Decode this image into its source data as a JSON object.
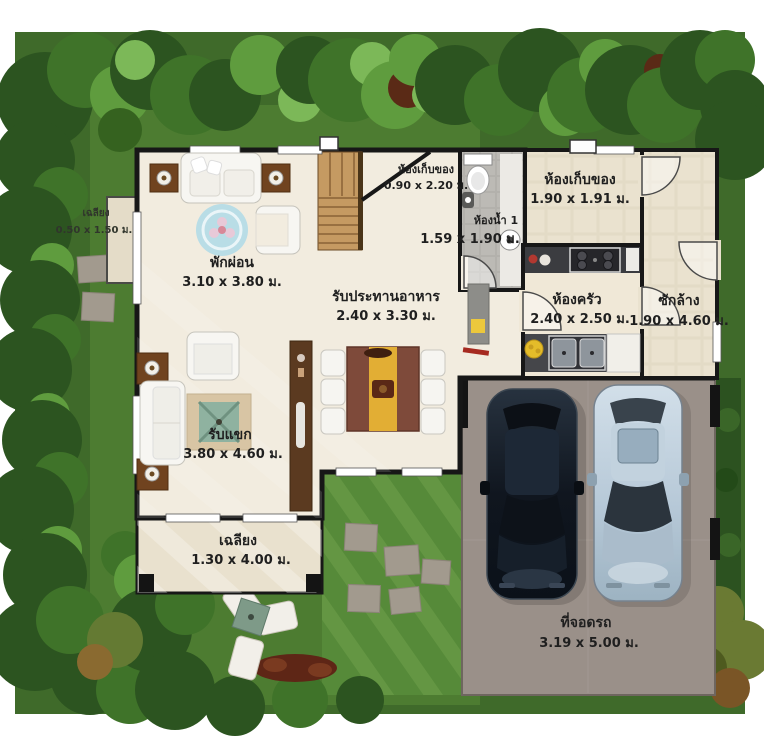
{
  "plan": {
    "type": "house-floor-plan",
    "rooms": [
      {
        "id": "relax",
        "name": "พักผ่อน",
        "dims": "3.10 x 3.80 ม."
      },
      {
        "id": "storage-under-stair",
        "name": "ห้องเก็บของ",
        "dims": "0.90 x 2.20 ม."
      },
      {
        "id": "bathroom-1",
        "name": "ห้องน้ำ 1",
        "dims": "1.59 x 1.90 ม."
      },
      {
        "id": "storage",
        "name": "ห้องเก็บของ",
        "dims": "1.90 x 1.91 ม."
      },
      {
        "id": "laundry",
        "name": "ซักล้าง",
        "dims": "1.90 x 4.60 ม."
      },
      {
        "id": "kitchen",
        "name": "ห้องครัว",
        "dims": "2.40 x 2.50 ม."
      },
      {
        "id": "dining",
        "name": "รับประทานอาหาร",
        "dims": "2.40 x 3.30 ม."
      },
      {
        "id": "living",
        "name": "รับแขก",
        "dims": "3.80 x 4.60 ม."
      },
      {
        "id": "porch-side",
        "name": "เฉลียง",
        "dims": "0.50 x 1.50 ม."
      },
      {
        "id": "porch-front",
        "name": "เฉลียง",
        "dims": "1.30 x 4.00 ม."
      },
      {
        "id": "parking",
        "name": "ที่จอดรถ",
        "dims": "3.19 x 5.00 ม."
      }
    ],
    "colors": {
      "wall": "#171717",
      "floor": "#f2ecdf",
      "tile": "#e7dfcb",
      "bathroom_floor": "#b9b7b2",
      "garage_floor": "#9a9089",
      "lawn": "#4f7c31",
      "foliage_dark": "#2c5420",
      "wood": "#5b3a20",
      "table_runner": "#e2ae34",
      "car_dark": "#141c26",
      "car_light": "#b7c9d8"
    }
  }
}
